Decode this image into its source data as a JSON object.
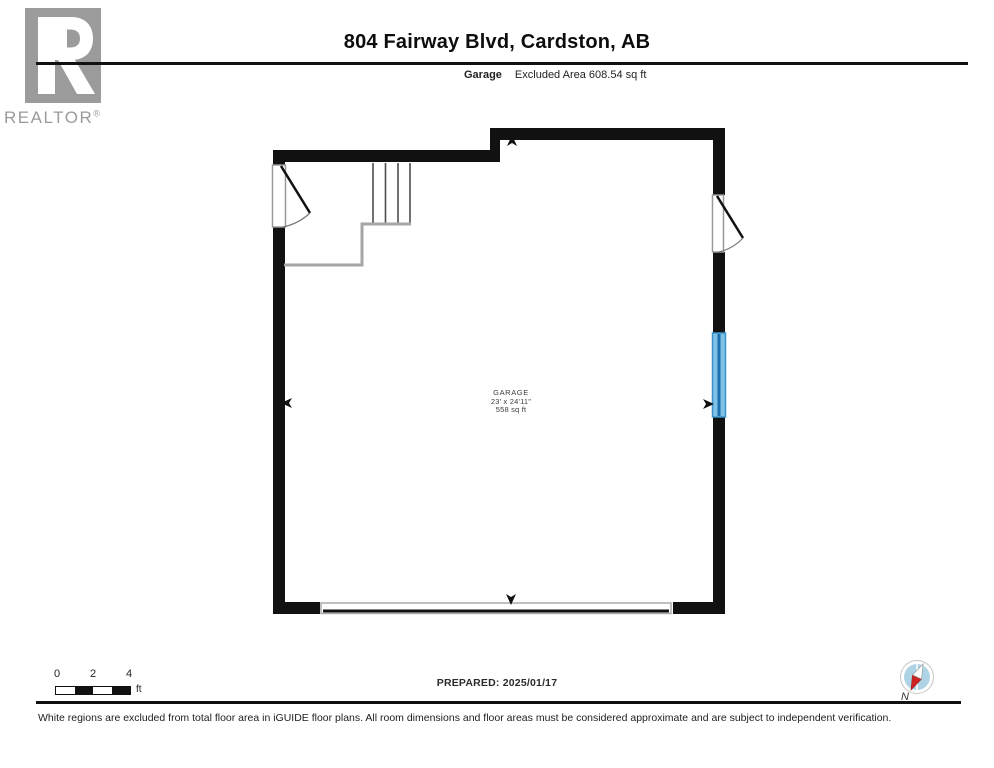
{
  "header": {
    "title": "804 Fairway Blvd, Cardston, AB",
    "floor_label": "Garage",
    "excluded_area": "Excluded Area 608.54 sq ft"
  },
  "logo": {
    "wordmark": "REALTOR",
    "registered": "®"
  },
  "floorplan": {
    "room": {
      "name": "GARAGE",
      "dimensions": "23' x 24'11\"",
      "area": "558 sq ft"
    }
  },
  "scale_bar": {
    "ticks": [
      "0",
      "2",
      "4"
    ],
    "unit": "ft"
  },
  "footer": {
    "prepared": "PREPARED: 2025/01/17",
    "compass_label": "N",
    "disclaimer": "White regions are excluded from total floor area in iGUIDE floor plans. All room dimensions and floor areas must be considered approximate and are subject to independent verification."
  },
  "colors": {
    "wall": "#111111",
    "window_fill": "#7fc2e8",
    "window_frame": "#3a93c9",
    "window_center": "#1d70ad",
    "landing_gray": "#a6a6a6",
    "logo_gray": "#9b9b9b",
    "compass_red": "#cc2222",
    "compass_blue": "#aed3e4"
  }
}
